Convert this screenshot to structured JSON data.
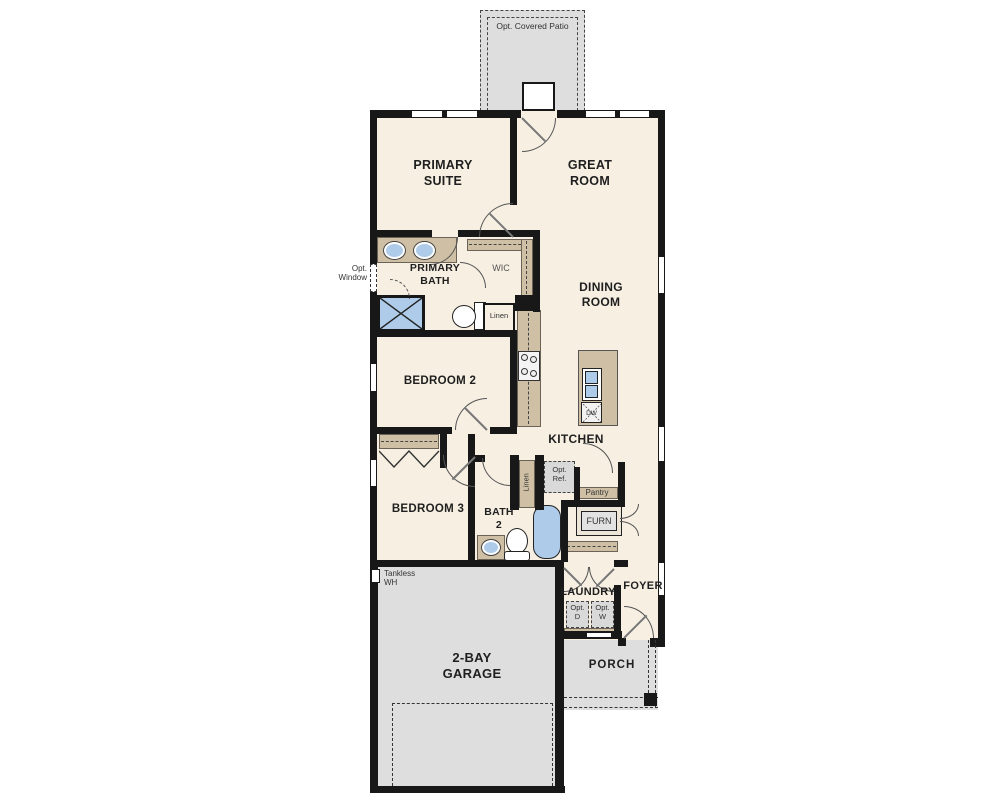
{
  "fp": {
    "patio": "Opt. Covered Patio",
    "primary_suite": "PRIMARY SUITE",
    "great_room": "GREAT ROOM",
    "opt_window": "Opt. Window",
    "primary_bath": "PRIMARY BATH",
    "wic": "WIC",
    "linen": "Linen",
    "dining_room": "DINING ROOM",
    "bedroom2": "BEDROOM 2",
    "kitchen": "KITCHEN",
    "dw": "DW",
    "bedroom3": "BEDROOM 3",
    "bath2": "BATH 2",
    "linen2": "Linen",
    "opt_ref": "Opt. Ref.",
    "pantry": "Pantry",
    "furn": "FURN",
    "tankless_wh": "Tankless WH",
    "laundry": "LAUNDRY",
    "opt_d": "Opt. D",
    "opt_w": "Opt. W",
    "foyer": "FOYER",
    "garage": "2-BAY GARAGE",
    "porch": "PORCH"
  },
  "colors": {
    "wall": "#181818",
    "floor": "#f6efe2",
    "counter": "#cfc0a5",
    "exterior_concrete": "#dedede",
    "plumbing_fixture": "#aecbe9"
  }
}
